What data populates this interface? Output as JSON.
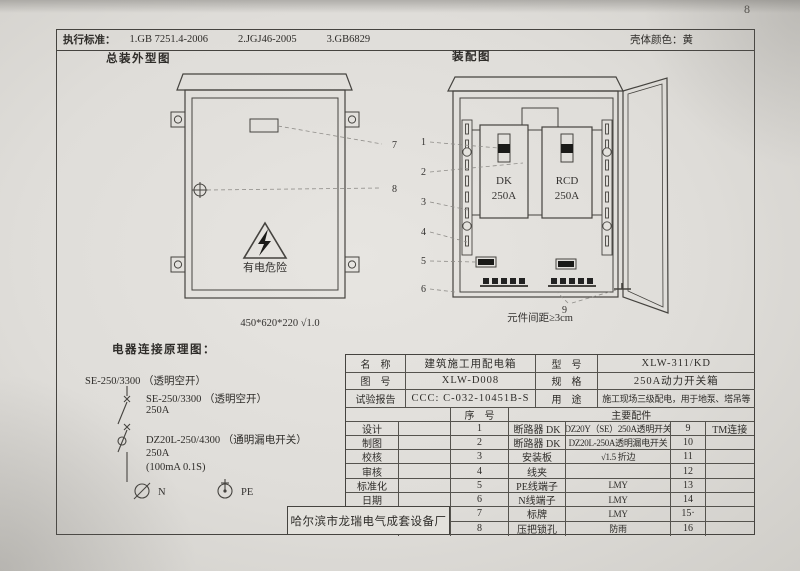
{
  "page": {
    "number": "8"
  },
  "header": {
    "standards_label": "执行标准：",
    "standard_1": "1.GB 7251.4-2006",
    "standard_2": "2.JGJ46-2005",
    "standard_3": "3.GB6829",
    "shell_color_label": "壳体颜色：",
    "shell_color_value": "黄"
  },
  "outline": {
    "title": "总装外型图",
    "warning_text": "有电危险",
    "dimensions": "450*620*220 √1.0",
    "leader_nameplate": "7",
    "leader_lock": "8"
  },
  "assembly": {
    "title": "装配图",
    "breaker_dk_name": "DK",
    "breaker_dk_rating": "250A",
    "breaker_rcd_name": "RCD",
    "breaker_rcd_rating": "250A",
    "leader_1": "1",
    "leader_2": "2",
    "leader_3": "3",
    "leader_4": "4",
    "leader_5": "5",
    "leader_6": "6",
    "leader_9": "9",
    "caption": "元件间距≥3cm"
  },
  "schematic": {
    "title": "电器连接原理图：",
    "incoming_label": "SE-250/3300 （透明空开）",
    "breaker1_model": "SE-250/3300 （透明空开）",
    "breaker1_rating": "250A",
    "breaker2_model": "DZ20L-250/4300 （通明漏电开关）",
    "breaker2_rating": "250A",
    "breaker2_params": "(100mA 0.1S)",
    "n_label": "N",
    "pe_label": "PE"
  },
  "title_block": {
    "name_label": "名　称",
    "name_value": "建筑施工用配电箱",
    "model_label": "型　号",
    "model_value": "XLW-311/KD",
    "drawing_no_label": "图　号",
    "drawing_no_value": "XLW-D008",
    "spec_label": "规　格",
    "spec_value": "250A动力开关箱",
    "report_label": "试验报告",
    "report_value": "CCC: C-032-10451B-S",
    "use_label": "用　途",
    "use_value": "施工现场三级配电，用于地泵、塔吊等",
    "seq_header": "序　号",
    "parts_header": "主要配件",
    "sign_labels": [
      "设计",
      "制图",
      "校核",
      "审核",
      "标准化",
      "日期"
    ],
    "parts": [
      {
        "no": "1",
        "name": "断路器 DK",
        "spec": "DZ20Y（SE）250A透明开关",
        "no2": "9",
        "spec2": "TM连接"
      },
      {
        "no": "2",
        "name": "断路器 DK",
        "spec": "DZ20L-250A透明漏电开关",
        "no2": "10",
        "spec2": ""
      },
      {
        "no": "3",
        "name": "安装板",
        "spec": "√1.5 折边",
        "no2": "11",
        "spec2": ""
      },
      {
        "no": "4",
        "name": "线夹",
        "spec": "",
        "no2": "12",
        "spec2": ""
      },
      {
        "no": "5",
        "name": "PE线端子",
        "spec": "LMY",
        "no2": "13",
        "spec2": ""
      },
      {
        "no": "6",
        "name": "N线端子",
        "spec": "LMY",
        "no2": "14",
        "spec2": ""
      },
      {
        "no": "7",
        "name": "标牌",
        "spec": "LMY",
        "no2": "15·",
        "spec2": ""
      },
      {
        "no": "8",
        "name": "压把锁孔",
        "spec": "防雨",
        "no2": "16",
        "spec2": ""
      }
    ],
    "company": "哈尔滨市龙瑞电气成套设备厂"
  }
}
